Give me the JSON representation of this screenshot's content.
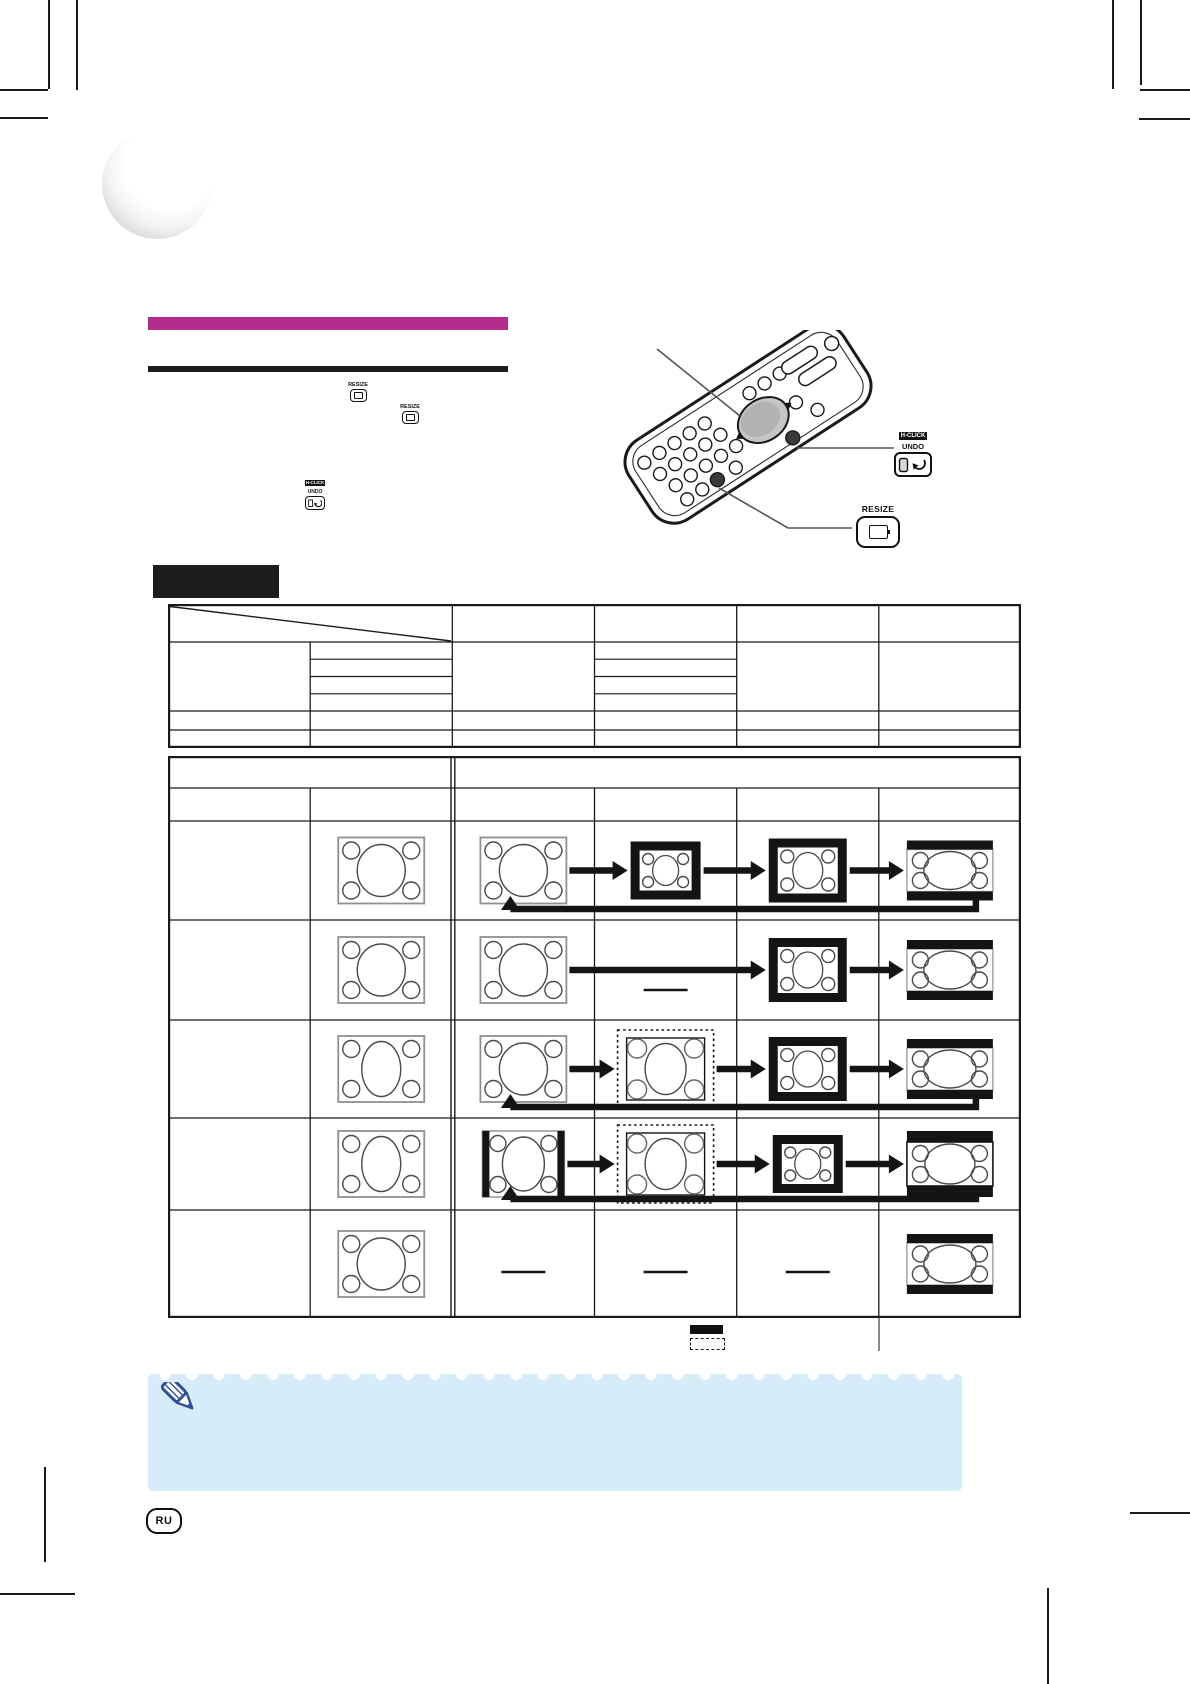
{
  "page": {
    "width": 1190,
    "height": 1684,
    "background": "#ffffff"
  },
  "branding": {
    "accent_color": "#b32b8c",
    "logo": "3d-sphere"
  },
  "labels": {
    "resize": "RESIZE",
    "h_click": "H-CLICK",
    "undo": "UNDO"
  },
  "remote": {
    "callouts": [
      "gyro-pad",
      "h-click-undo-button",
      "resize-button"
    ]
  },
  "format_table": {
    "columns": 6,
    "diagonal_header_cell": true,
    "sub_rows_in_column2": 4,
    "sub_rows_in_column4": 4,
    "extra_bottom_rows": 2,
    "all_cells_blank": true
  },
  "resize_table": {
    "header_spans": [
      "left-2-columns",
      "right-4-columns"
    ],
    "rows": [
      {
        "display_cell": "screen-4x3",
        "sequence": [
          "screen-4x3",
          "black-frame-small",
          "black-frame-medium",
          "letterbox"
        ],
        "arrows": [
          [
            0,
            1
          ],
          [
            1,
            2
          ],
          [
            2,
            3
          ]
        ],
        "return_arrow": [
          3,
          0
        ]
      },
      {
        "display_cell": "screen-4x3",
        "sequence": [
          "screen-4x3",
          "dash",
          "black-frame-medium",
          "letterbox"
        ],
        "arrows": [
          [
            0,
            2
          ],
          [
            2,
            3
          ]
        ],
        "return_arrow": null
      },
      {
        "display_cell": "screen-4x3-tall-ellipse",
        "sequence": [
          "screen-4x3",
          "dotted-frame",
          "black-frame-medium",
          "letterbox"
        ],
        "arrows": [
          [
            0,
            1
          ],
          [
            1,
            2
          ],
          [
            2,
            3
          ]
        ],
        "return_arrow": [
          3,
          0
        ]
      },
      {
        "display_cell": "screen-4x3-tall-ellipse",
        "sequence": [
          "pillarbox",
          "dotted-frame",
          "black-frame-small",
          "letterbox-thick"
        ],
        "arrows": [
          [
            0,
            1
          ],
          [
            1,
            2
          ],
          [
            2,
            3
          ]
        ],
        "return_arrow": [
          3,
          0
        ]
      },
      {
        "display_cell": "screen-4x3",
        "sequence": [
          "dash",
          "dash",
          "dash",
          "letterbox"
        ],
        "arrows": [],
        "return_arrow": null
      }
    ],
    "legend": {
      "items": [
        {
          "swatch": "solid-black-box"
        },
        {
          "swatch": "dotted-outline-box"
        }
      ]
    }
  },
  "note": {
    "icon": "pencil-icon",
    "background": "#d6ecf8",
    "pencil_color": "#2d4f9c"
  },
  "footer": {
    "language_badge": "RU"
  }
}
